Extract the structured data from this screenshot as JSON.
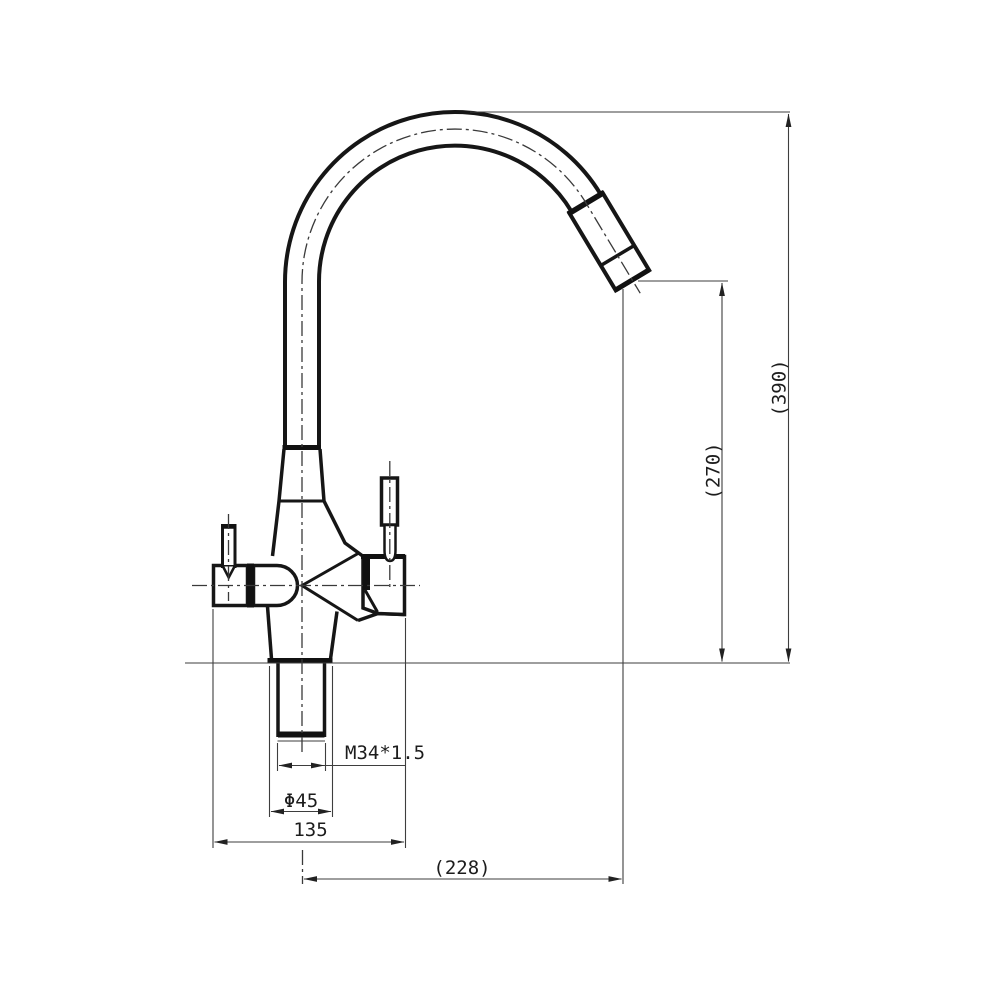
{
  "drawing": {
    "type": "faucet-technical-drawing",
    "labels": {
      "overall_height": "(390)",
      "spout_height": "(270)",
      "thread_spec": "M34*1.5",
      "flange_diameter": "Φ45",
      "body_width": "135",
      "spout_reach": "(228)"
    },
    "colors": {
      "line": "#161616",
      "dimension_line": "#3e3e3e",
      "background": "#ffffff"
    }
  }
}
